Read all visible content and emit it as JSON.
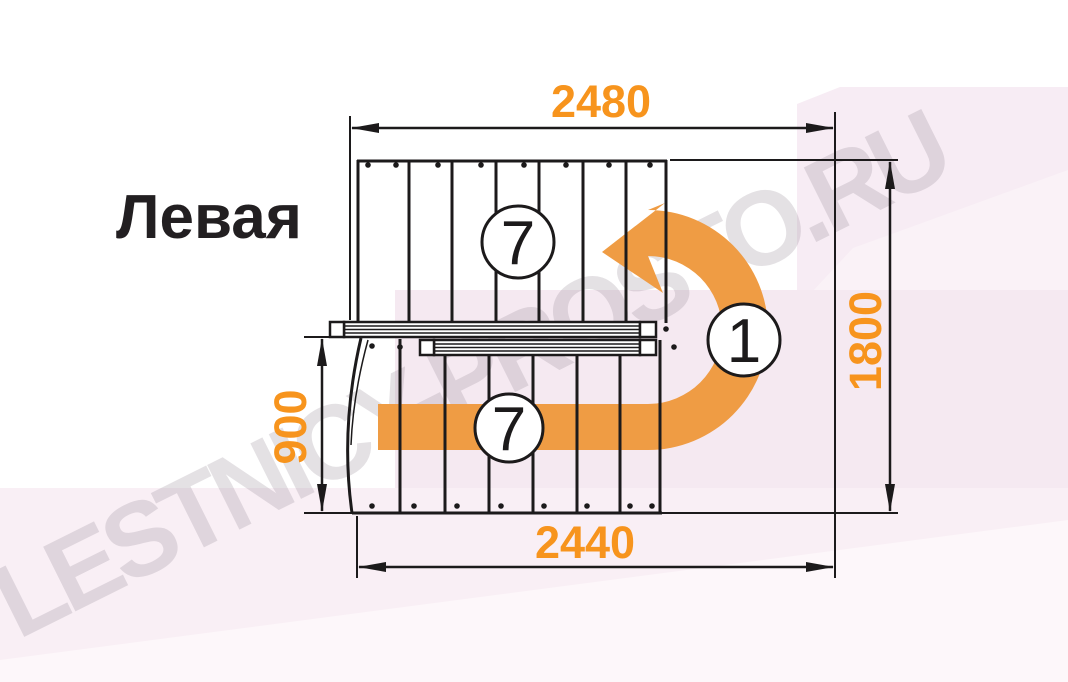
{
  "title": "Левая",
  "watermark": "LESTNICY-PROSTO.RU",
  "dimensions": {
    "top_width": "2480",
    "bottom_width": "2440",
    "total_depth": "1800",
    "flight_width": "900"
  },
  "step_counts": {
    "top_flight": "7",
    "bottom_flight": "7",
    "turn_step": "1"
  },
  "colors": {
    "dimension_text": "#f7941d",
    "arrow_orange": "#ef9c44",
    "line": "#1c1a1b",
    "background_pink": "#f5e9f1",
    "background_pink_light": "#faf0f6",
    "watermark_gray": "#9e949e"
  }
}
